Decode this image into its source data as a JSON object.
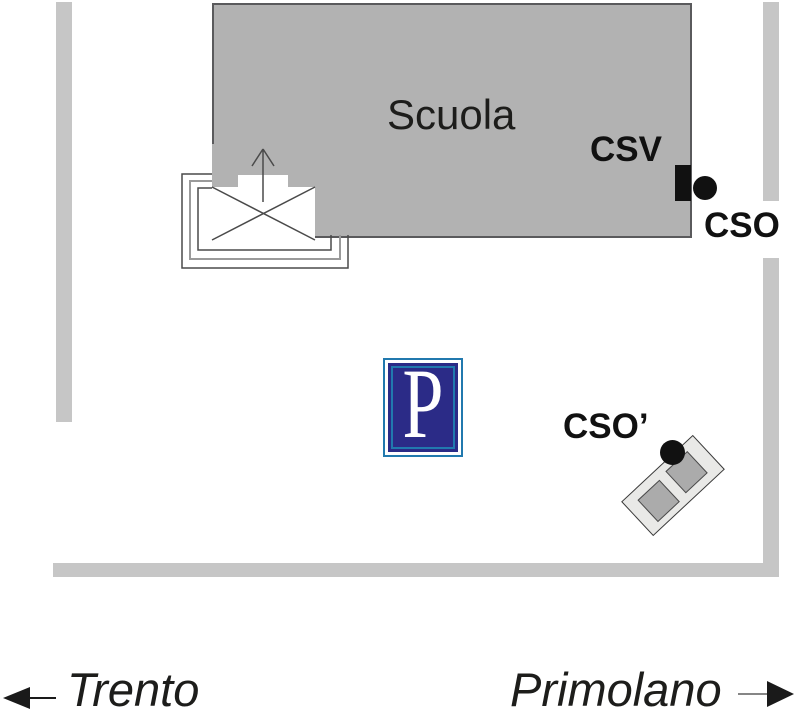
{
  "building": {
    "label": "Scuola"
  },
  "markers": {
    "csv": {
      "label": "CSV"
    },
    "cso": {
      "label": "CSO"
    },
    "cso_prime": {
      "label": "CSO’"
    }
  },
  "parking_sign": {
    "letter": "P"
  },
  "destinations": {
    "left": "Trento",
    "right": "Primolano"
  },
  "colors": {
    "road": "#c6c6c6",
    "building-fill": "#b2b2b2",
    "building-border": "#5a5a5c",
    "marker-black": "#111111",
    "label-text": "#1d1d1b",
    "parking-navy": "#2b2b87",
    "parking-cyan": "#2179ae",
    "annex-fill": "#e9e9e7",
    "annex-inner": "#ababab"
  }
}
